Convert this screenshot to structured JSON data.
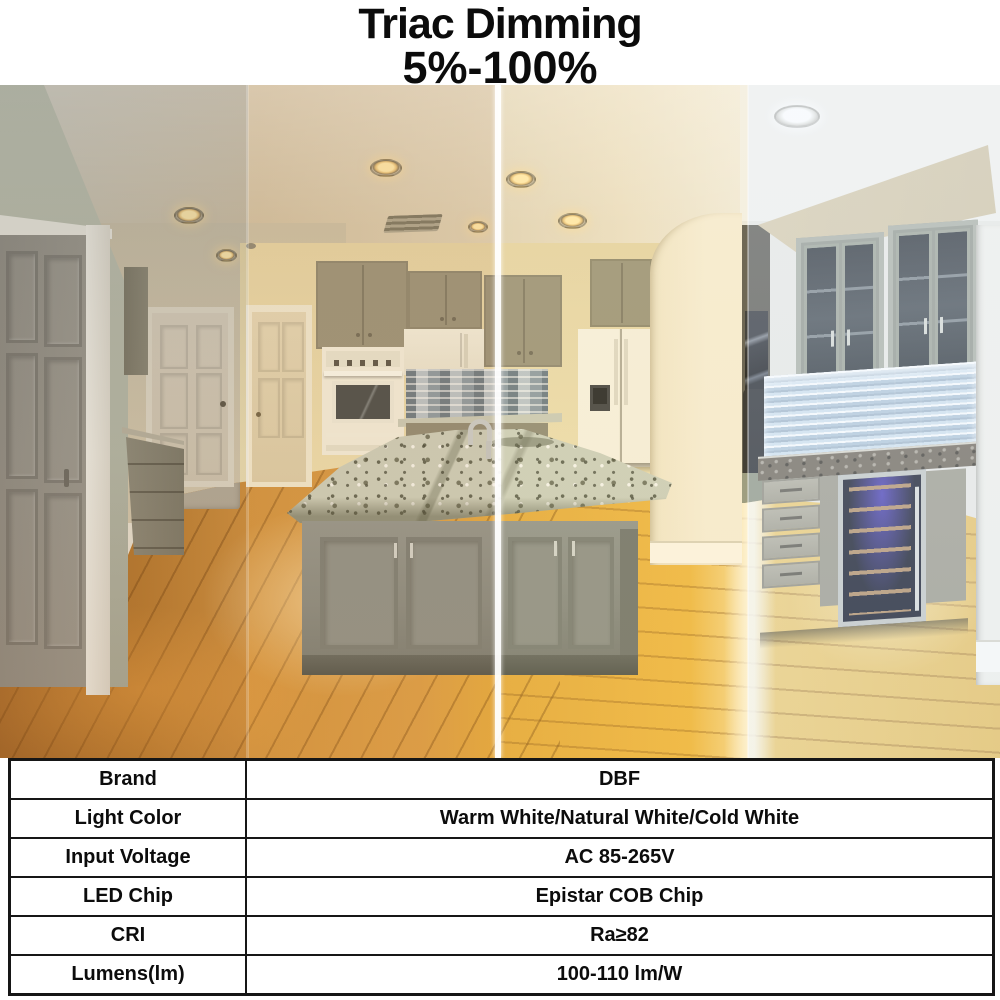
{
  "header": {
    "title": "Triac Dimming",
    "subtitle": "5%-100%"
  },
  "photo": {
    "zone_tint_colors": [
      "#b07a33",
      "#e3a54d",
      "#f0c55a",
      "#e9f1f8"
    ],
    "divider_color": "#ffffff"
  },
  "spec_table": {
    "rows": [
      {
        "label": "Brand",
        "value": "DBF"
      },
      {
        "label": "Light Color",
        "value": "Warm White/Natural White/Cold White"
      },
      {
        "label": "Input Voltage",
        "value": "AC 85-265V"
      },
      {
        "label": "LED Chip",
        "value": "Epistar COB Chip"
      },
      {
        "label": "CRI",
        "value": "Ra≥82"
      },
      {
        "label": "Lumens(lm)",
        "value": "100-110 lm/W"
      }
    ]
  }
}
